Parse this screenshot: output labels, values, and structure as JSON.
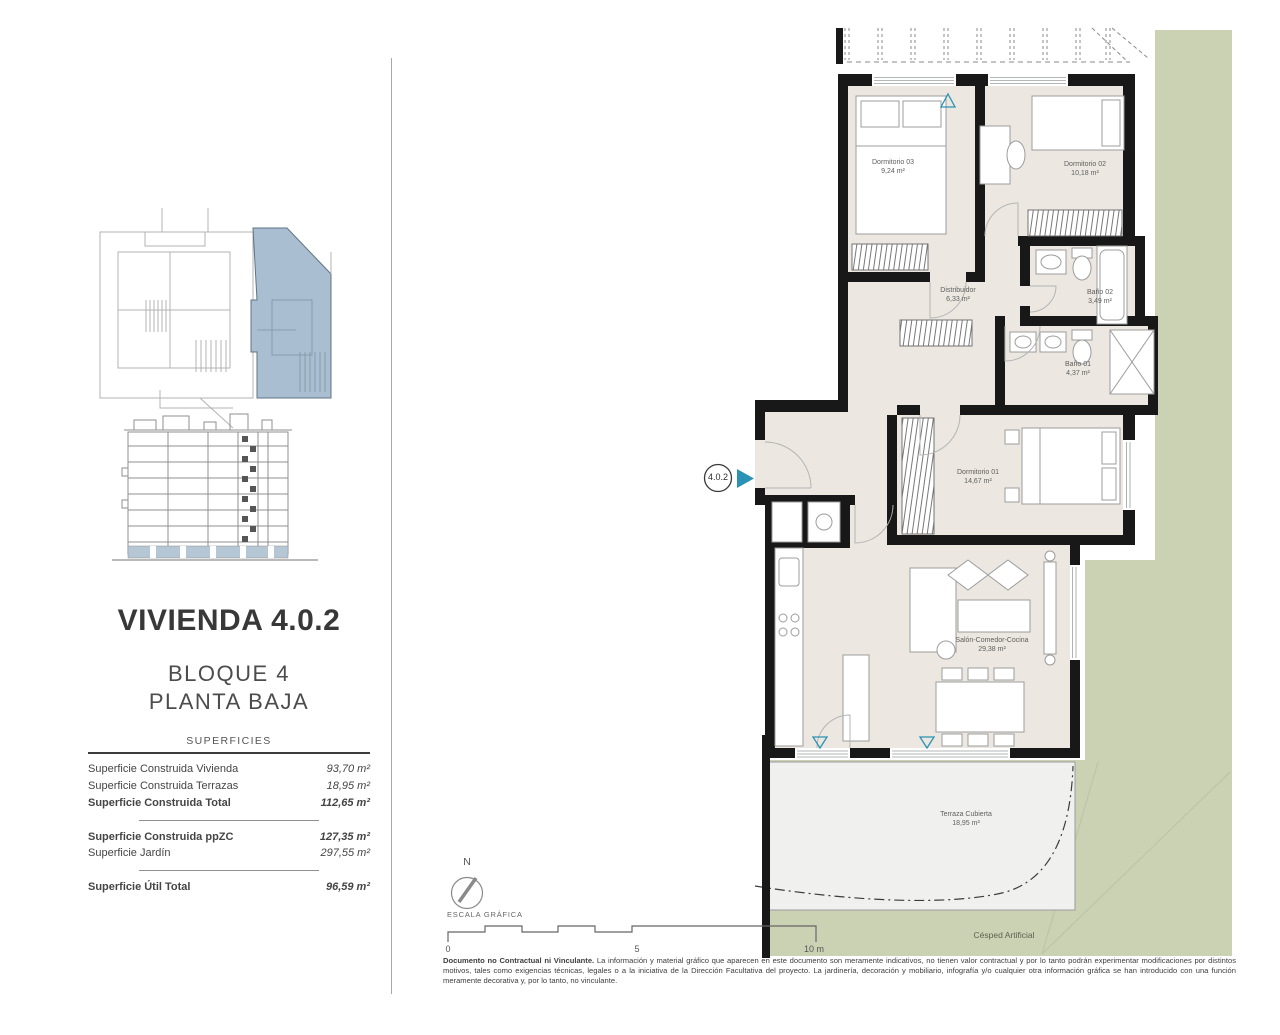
{
  "panel": {
    "title": "VIVIENDA 4.0.2",
    "block": "BLOQUE 4",
    "floor": "PLANTA BAJA",
    "table_header": "SUPERFICIES",
    "rows": [
      {
        "label": "Superficie Construida Vivienda",
        "value": "93,70 m²"
      },
      {
        "label": "Superficie Construida Terrazas",
        "value": "18,95 m²"
      },
      {
        "label": "Superficie Construida Total",
        "value": "112,65 m²"
      },
      {
        "label": "Superficie Construida ppZC",
        "value": "127,35 m²"
      },
      {
        "label": "Superficie Jardín",
        "value": "297,55 m²"
      },
      {
        "label": "Superficie Útil Total",
        "value": "96,59 m²"
      }
    ]
  },
  "plan": {
    "unit_marker": "4.0.2",
    "compass": "N",
    "scale_title": "ESCALA GRÁFICA",
    "scale_ticks": [
      "0",
      "5",
      "10 m"
    ],
    "garden_label": "Césped Artificial",
    "rooms": [
      {
        "name": "Dormitorio 03",
        "area": "9,24 m²"
      },
      {
        "name": "Dormitorio 02",
        "area": "10,18 m²"
      },
      {
        "name": "Distribuidor",
        "area": "6,33 m²"
      },
      {
        "name": "Baño 02",
        "area": "3,49 m²"
      },
      {
        "name": "Baño 01",
        "area": "4,37 m²"
      },
      {
        "name": "Dormitorio 01",
        "area": "14,67 m²"
      },
      {
        "name": "Salón-Comedor-Cocina",
        "area": "29,38 m²"
      },
      {
        "name": "Terraza Cubierta",
        "area": "18,95 m²"
      }
    ]
  },
  "footer": {
    "disclaimer_lead": "Documento no Contractual ni Vinculante.",
    "disclaimer_body": " La información y material gráfico que aparecen en este documento son meramente indicativos, no tienen valor contractual y por lo tanto podrán experimentar modificaciones por distintos motivos, tales como exigencias técnicas, legales o a la iniciativa de la Dirección Facultativa del proyecto. La jardinería, decoración y mobiliario, infografía y/o cualquier otra información gráfica se han introducido con una función meramente decorativa y, por lo tanto, no vinculante."
  },
  "colors": {
    "wall": "#181818",
    "floor_beige": "#ece7e0",
    "garden_green": "#cbd2b4",
    "terrace_grey": "#f0f1ee",
    "keyplan_blue": "#a9bed0",
    "accent_teal": "#2a93b5"
  }
}
